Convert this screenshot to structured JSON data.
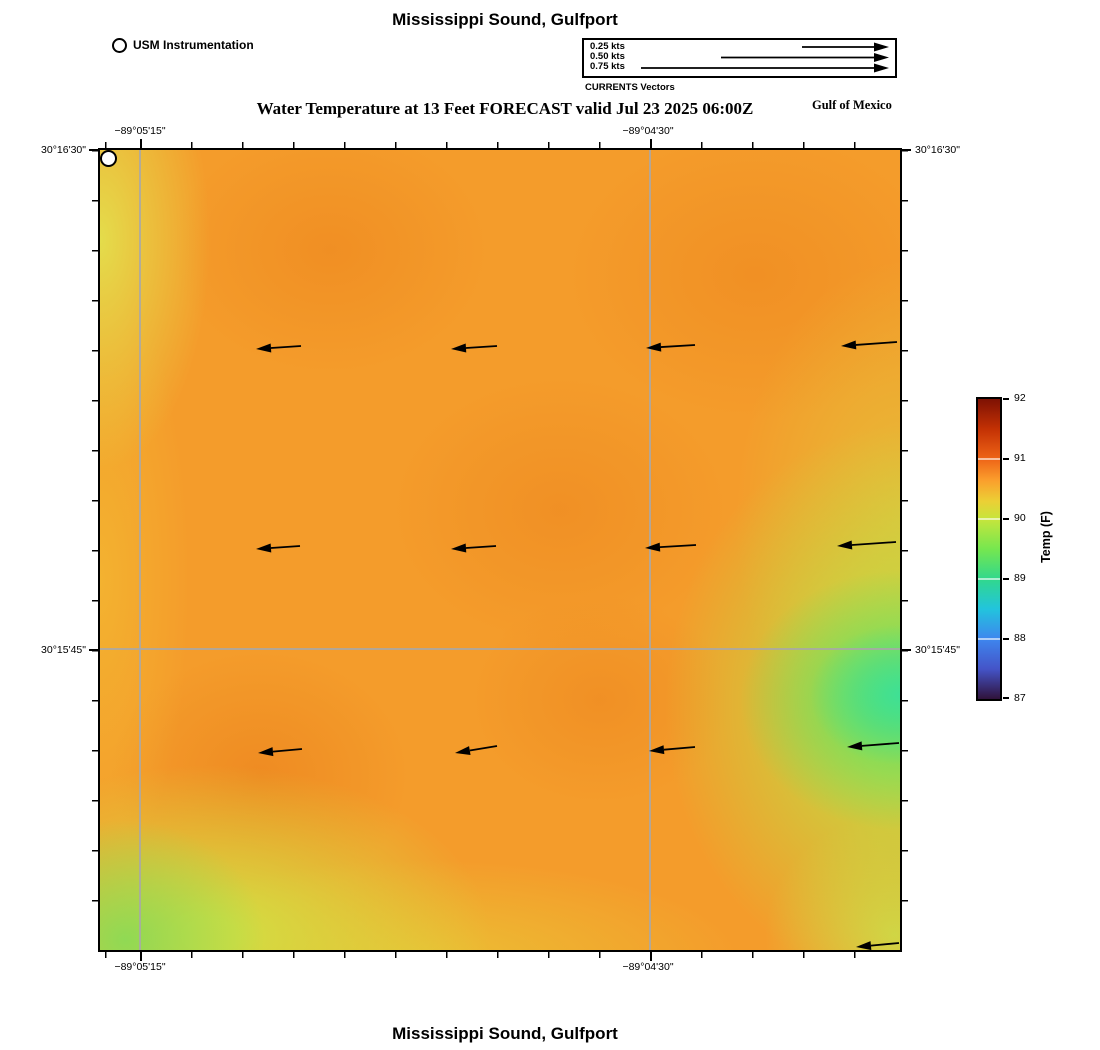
{
  "page": {
    "title_top": "Mississippi Sound, Gulfport",
    "subtitle": "Water Temperature at 13 Feet FORECAST valid Jul 23 2025 06:00Z",
    "gulf_label": "Gulf of Mexico",
    "title_bottom": "Mississippi Sound, Gulfport"
  },
  "usm_legend": {
    "label": "USM Instrumentation"
  },
  "currents_legend": {
    "caption": "CURRENTS Vectors",
    "items": [
      "0.25 kts",
      "0.50 kts",
      "0.75 kts"
    ]
  },
  "axes": {
    "lon_left": "−89°05'15\"",
    "lon_right": "−89°04'30\"",
    "lat_top": "30°16'30\"",
    "lat_bottom": "30°15'45\""
  },
  "colorbar": {
    "label": "Temp (F)",
    "ticks": [
      "92",
      "91",
      "90",
      "89",
      "88",
      "87"
    ]
  },
  "chart_data": {
    "type": "heatmap",
    "title": "Mississippi Sound, Gulfport",
    "subtitle": "Water Temperature at 13 Feet FORECAST valid Jul 23 2025 06:00Z",
    "region_label": "Gulf of Mexico",
    "x_axis": {
      "label": "longitude",
      "ticks": [
        "−89°05'15\"",
        "−89°04'30\""
      ]
    },
    "y_axis": {
      "label": "latitude",
      "ticks": [
        "30°16'30\"",
        "30°15'45\""
      ]
    },
    "colorbar": {
      "label": "Temp (F)",
      "min": 87,
      "max": 92,
      "ticks": [
        92,
        91,
        90,
        89,
        88,
        87
      ],
      "colormap": "turbo-like (dark blue → cyan → green → yellow → orange → dark red)"
    },
    "temperature_grid_f": {
      "note": "approximate field values read from colors, rows north→south, cols west→east",
      "values": [
        [
          90.2,
          90.6,
          90.7,
          90.8,
          90.7,
          90.3
        ],
        [
          90.3,
          90.8,
          90.7,
          90.9,
          90.8,
          89.9
        ],
        [
          90.4,
          90.7,
          90.8,
          90.7,
          90.1,
          89.0
        ],
        [
          90.2,
          90.8,
          90.7,
          90.8,
          90.2,
          88.9
        ],
        [
          89.8,
          90.2,
          90.5,
          90.6,
          90.3,
          90.0
        ]
      ]
    },
    "station": {
      "name": "USM Instrumentation",
      "map_x_px": 337,
      "map_y_px": 560
    },
    "current_note": "uniform westward flow, arrow length ≈ 0.25 kts scale",
    "vectors": [
      {
        "layer": "map",
        "x1": 201,
        "y1": 196,
        "x2": 156,
        "y2": 199
      },
      {
        "layer": "map",
        "x1": 397,
        "y1": 196,
        "x2": 351,
        "y2": 199
      },
      {
        "layer": "map",
        "x1": 595,
        "y1": 195,
        "x2": 546,
        "y2": 198
      },
      {
        "layer": "map",
        "x1": 797,
        "y1": 192,
        "x2": 741,
        "y2": 196
      },
      {
        "layer": "map",
        "x1": 200,
        "y1": 396,
        "x2": 156,
        "y2": 399
      },
      {
        "layer": "map",
        "x1": 396,
        "y1": 396,
        "x2": 351,
        "y2": 399
      },
      {
        "layer": "map",
        "x1": 596,
        "y1": 395,
        "x2": 545,
        "y2": 398
      },
      {
        "layer": "map",
        "x1": 796,
        "y1": 392,
        "x2": 737,
        "y2": 396
      },
      {
        "layer": "map",
        "x1": 202,
        "y1": 599,
        "x2": 158,
        "y2": 603
      },
      {
        "layer": "map",
        "x1": 397,
        "y1": 596,
        "x2": 355,
        "y2": 603
      },
      {
        "layer": "map",
        "x1": 595,
        "y1": 597,
        "x2": 549,
        "y2": 601
      },
      {
        "layer": "map",
        "x1": 799,
        "y1": 593,
        "x2": 747,
        "y2": 597
      },
      {
        "layer": "map",
        "x1": 799,
        "y1": 793,
        "x2": 756,
        "y2": 797
      },
      {
        "layer": "legend",
        "x1": 218,
        "y1": 7,
        "x2": 305,
        "y2": 7
      },
      {
        "layer": "legend",
        "x1": 137,
        "y1": 17.5,
        "x2": 305,
        "y2": 17.5
      },
      {
        "layer": "legend",
        "x1": 57,
        "y1": 28,
        "x2": 305,
        "y2": 28
      }
    ]
  }
}
